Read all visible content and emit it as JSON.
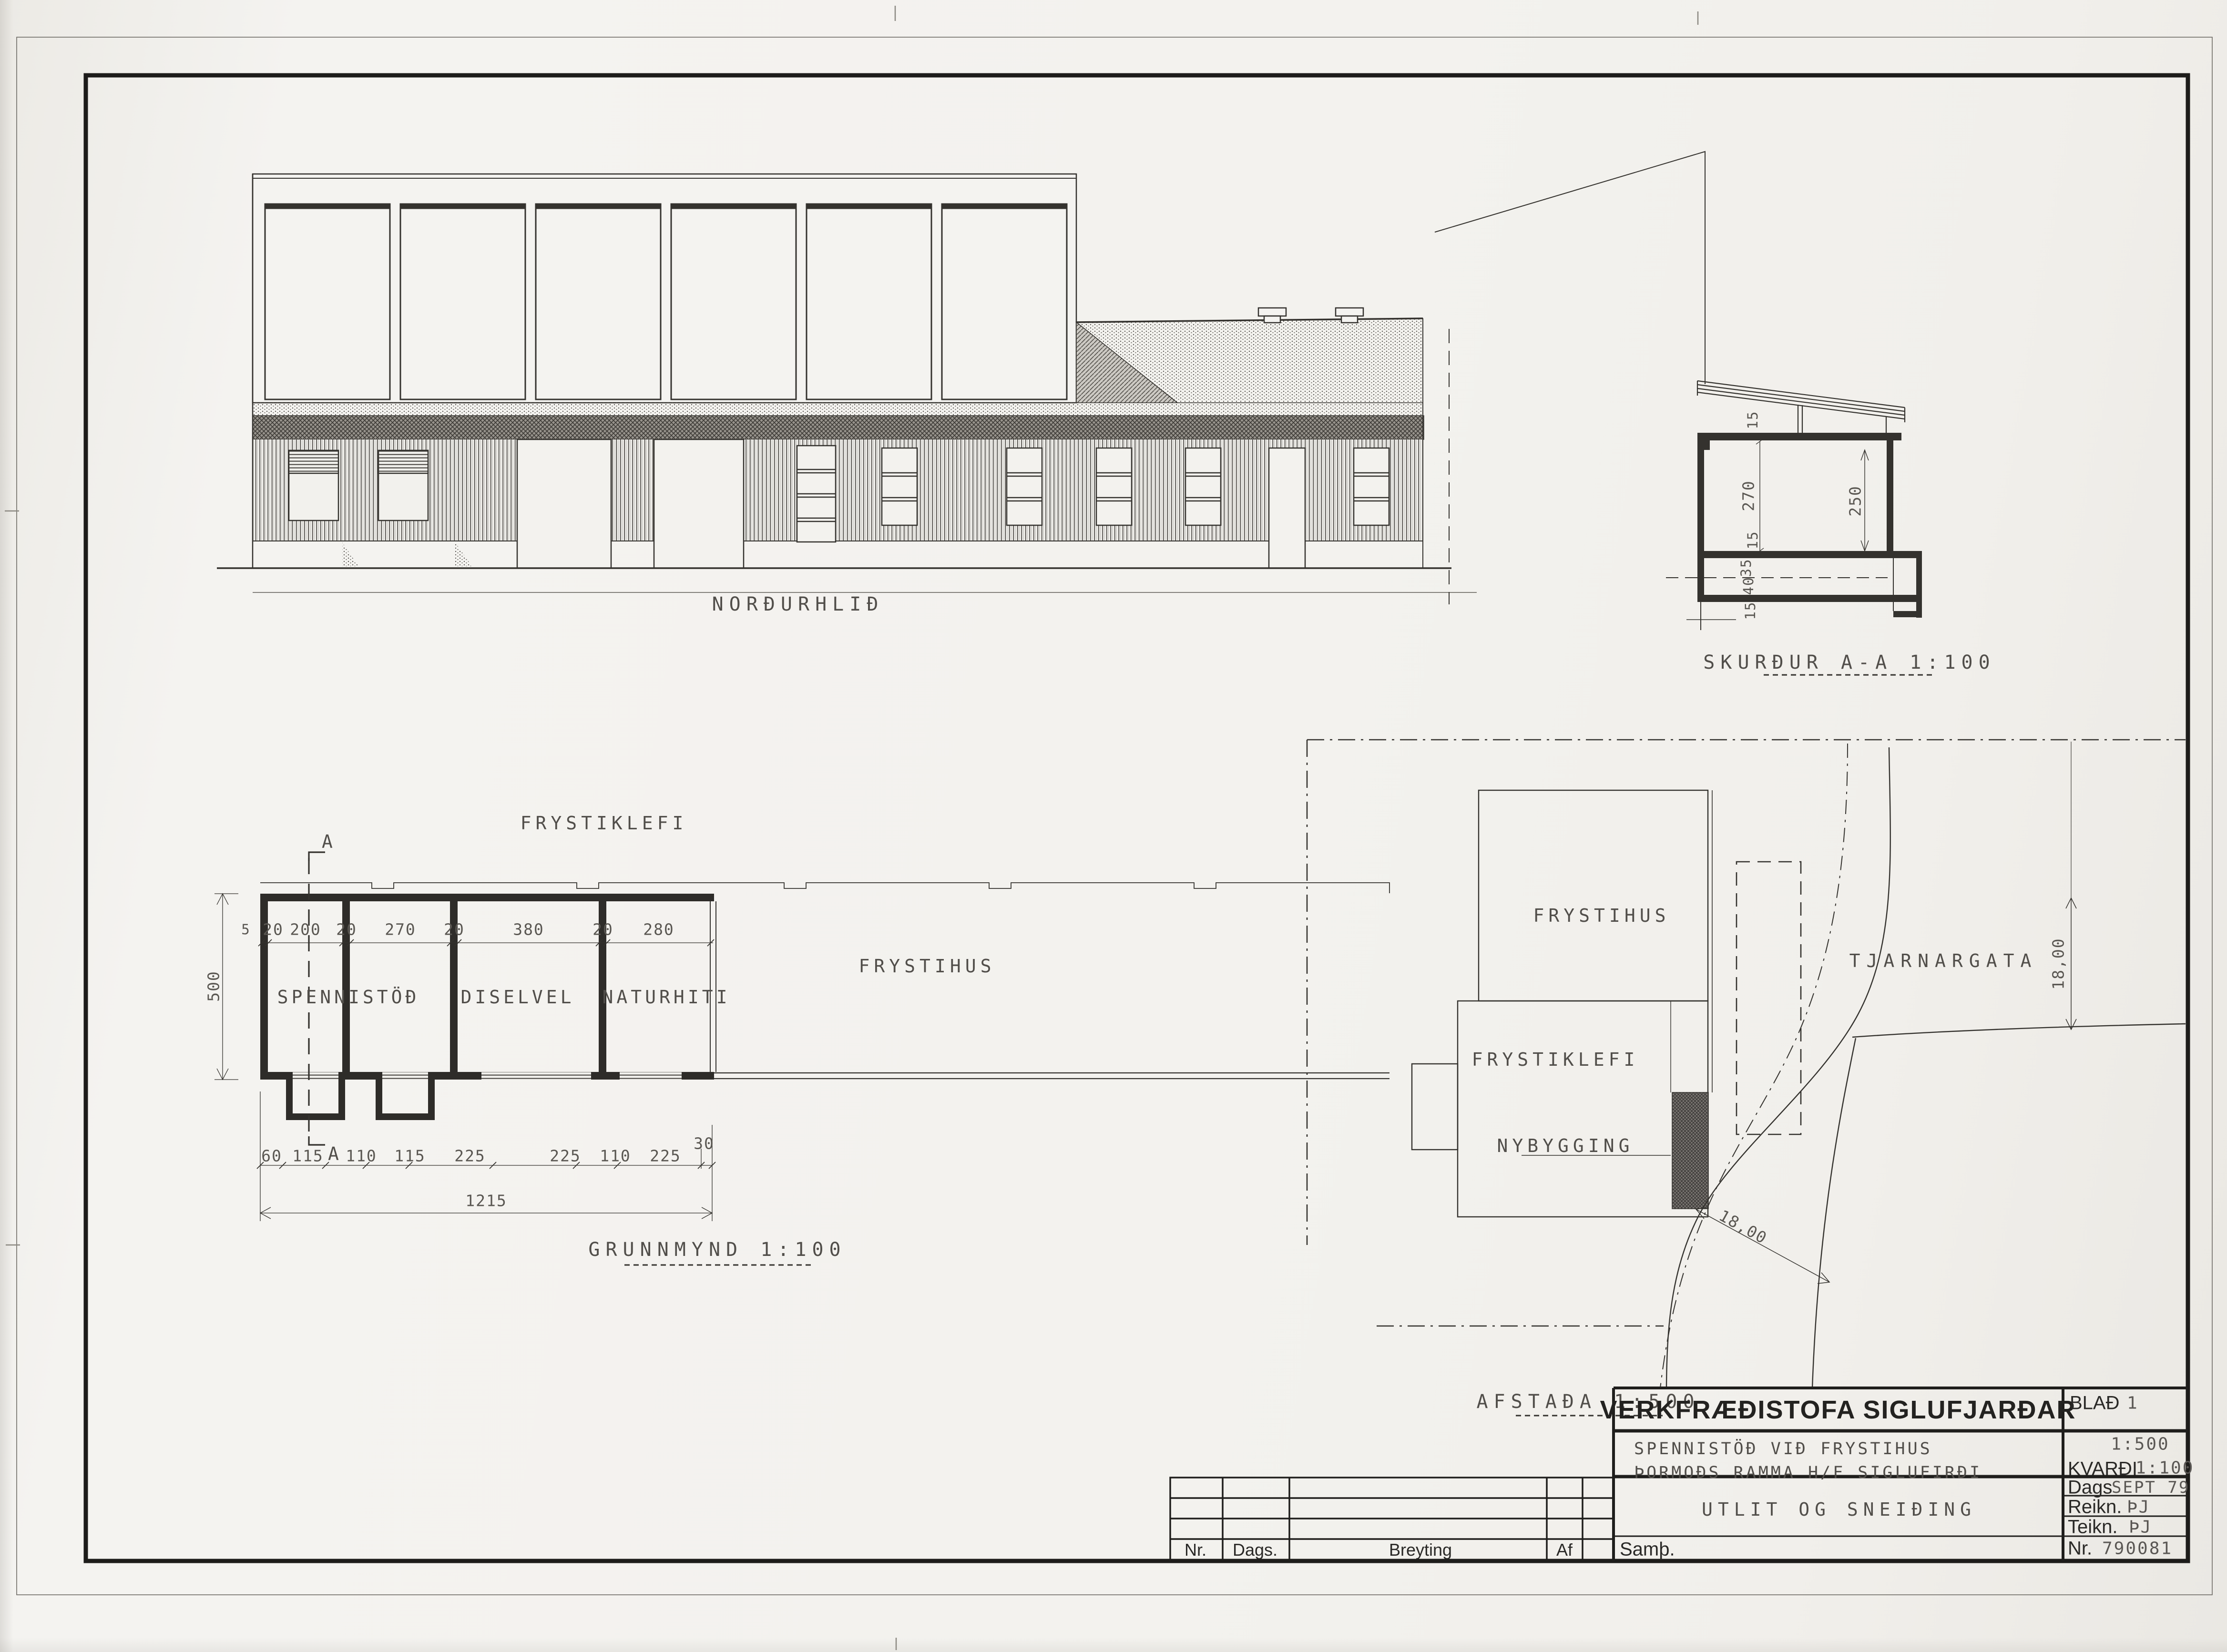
{
  "colors": {
    "paper": "#f3f2ee",
    "ink": "#34322e"
  },
  "elevation": {
    "label": "NORÐURHLIÐ"
  },
  "section": {
    "label": "SKURÐUR A-A 1:100",
    "dims_left": [
      "15",
      "270",
      "15",
      "35",
      "40",
      "15"
    ],
    "dim_right": "250"
  },
  "plan": {
    "label": "GRUNNMYND 1:100",
    "area_above": "FRYSTIKLEFI",
    "rooms": [
      "SPENNISTÖÐ",
      "DISELVEL",
      "NATURHITI"
    ],
    "hall_label": "FRYSTIHUS",
    "marker": "A",
    "top_dims": [
      "5",
      "20",
      "200",
      "20",
      "270",
      "20",
      "380",
      "20",
      "280"
    ],
    "left_dim": "500",
    "bottom_dims": [
      "60",
      "115",
      "110",
      "115",
      "225",
      "225",
      "110",
      "225",
      "30"
    ],
    "total_dim": "1215"
  },
  "site": {
    "label": "AFSTAÐA 1:500",
    "frystihus": "FRYSTIHUS",
    "frystiklefi": "FRYSTIKLEFI",
    "nybygging": "NYBYGGING",
    "street": "TJARNARGATA",
    "dim_a": "18,00",
    "dim_b": "18,00"
  },
  "titleblock": {
    "company": "VERKFRÆÐISTOFA SIGLUFJARÐAR",
    "blad_label": "BLAÐ",
    "blad_value": "1",
    "project1": "SPENNISTÖÐ VIÐ FRYSTIHUS",
    "project2": "ÞORMOÐS RAMMA H/F  SIGLUFIRÐI",
    "scale1": "1:500",
    "kvardi_label": "KVARÐI",
    "kvardi_value": "1:100",
    "title": "UTLIT OG SNEIÐING",
    "dags_label": "Dags",
    "dags_value": "SEPT 79",
    "reikn_label": "Reikn.",
    "reikn_value": "ÞJ",
    "teikn_label": "Teikn.",
    "teikn_value": "ÞJ",
    "nr_label": "Nr.",
    "nr_value": "790081",
    "samp": "Samþ."
  },
  "revisions": {
    "headers": [
      "Nr.",
      "Dags.",
      "Breyting",
      "Af"
    ]
  }
}
